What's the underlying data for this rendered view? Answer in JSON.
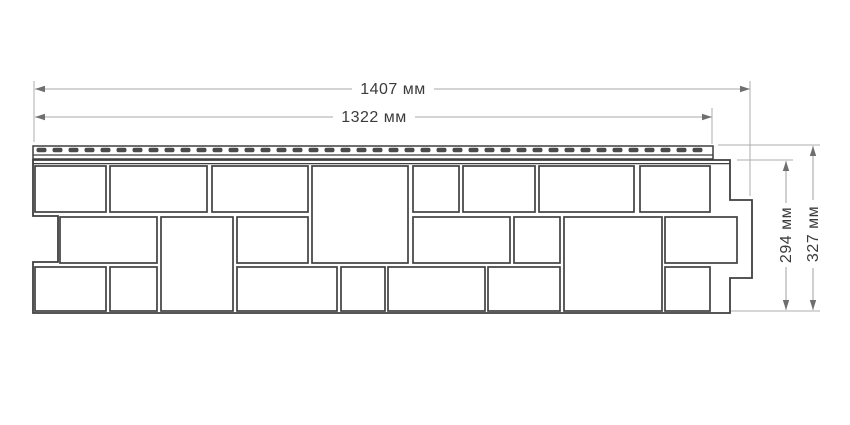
{
  "drawing": {
    "type": "technical-dimension-drawing",
    "subject": "facade siding panel with stone-block pattern and top nailing strip, front view",
    "dimensions": {
      "width_total": "1407 мм",
      "width_panel": "1322 мм",
      "height_panel": "294 мм",
      "height_total": "327 мм"
    },
    "colors": {
      "background": "#ffffff",
      "panel_outline": "#3f3f3f",
      "block_fill": "#ffffff",
      "nail_slot": "#4a4a4a",
      "dimension_line": "#a8a8a8",
      "arrowhead": "#6f6f6f",
      "label_text": "#3b3b3b"
    }
  }
}
